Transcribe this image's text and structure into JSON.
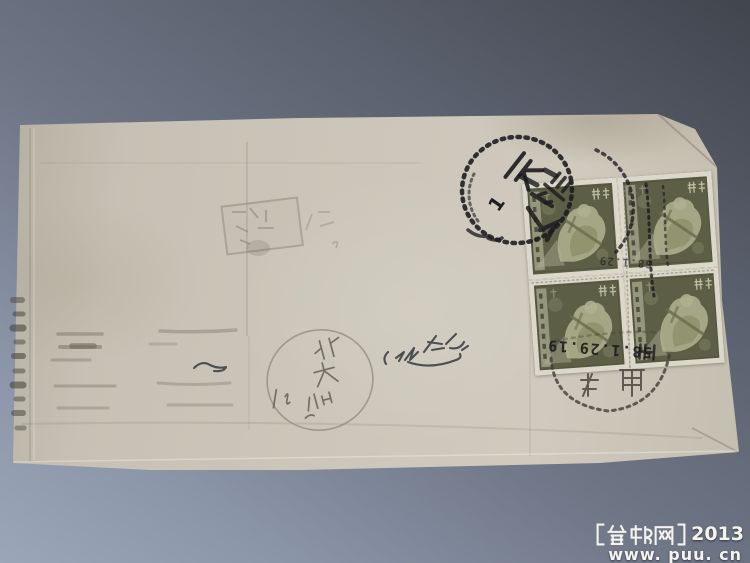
{
  "scene": {
    "background": {
      "top_color": "#41454e",
      "bottom_color": "#9ba6b7"
    },
    "watermark": {
      "line1": "【普邮网】2013",
      "site_name": "普邮网",
      "year": "2013",
      "line2": "www. puu. cn",
      "text_color": "#f4f3f0"
    }
  },
  "envelope": {
    "paper_color": "#cbc6b9",
    "stamp_block": {
      "count": 4,
      "rows": 2,
      "cols": 2,
      "stamp_color": "#5c5e45",
      "perforation_color": "#dbd7ca",
      "country_inscription": "中国人民邮政",
      "denomination": "4分",
      "value_characters": "肆分",
      "orientation": "rotated sideways"
    },
    "cancellation": {
      "ink_color": "#1d1d20",
      "city": "天津",
      "numeral": "1",
      "date_line": "58.1.29.19",
      "date_line_faint": "58.1.29"
    },
    "pencil_annotation": {
      "characters": "北 大 仙",
      "color": "#605c52"
    },
    "markings": {
      "bold_postmark": "beaded-circle Tianjin cancel",
      "receiving_postmark": "faint dotted-circle cancel below stamps",
      "pencil_postmark": "very faint pencil circle with handwriting",
      "chop": "faint rectangular seal impression",
      "handwriting": "illegible cursive ink",
      "offset_bands": "gray transferred ink streaks on left half"
    }
  }
}
